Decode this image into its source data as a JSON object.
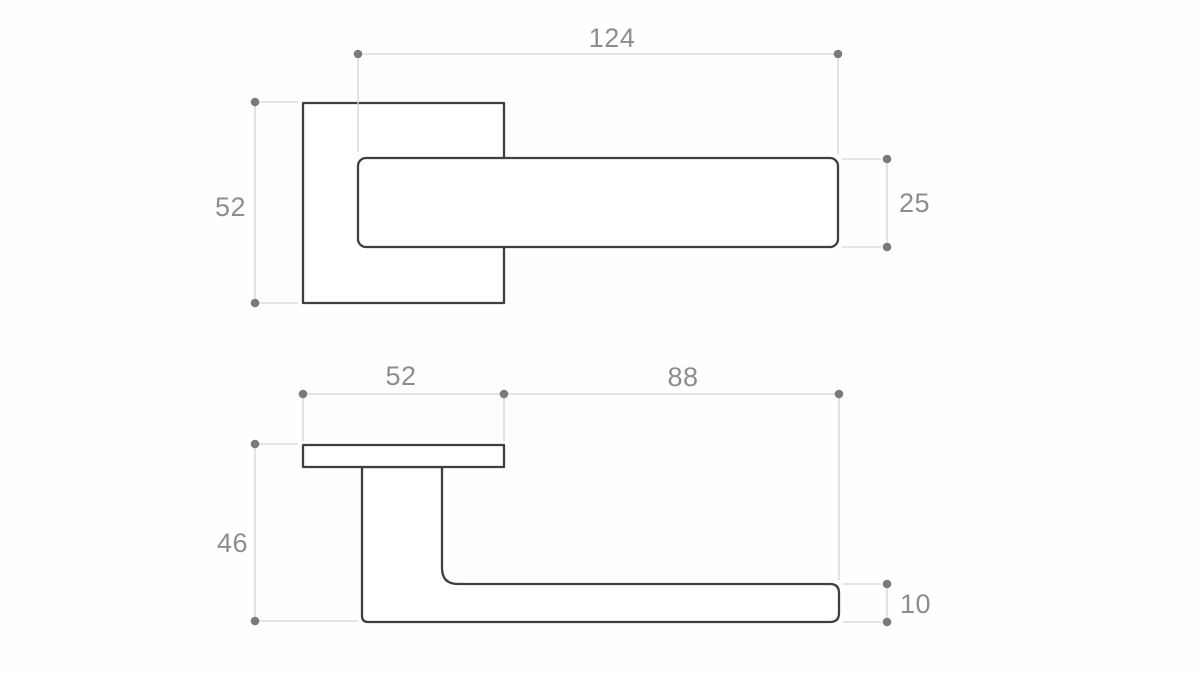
{
  "drawing": {
    "type": "technical-dimension-drawing",
    "subject": "door-lever-handle-on-square-rosette",
    "unit_note": "",
    "colors": {
      "background": "#fefefe",
      "outline": "#3f3f3f",
      "dimension_line": "#d4d4d4",
      "dimension_dot": "#7a7a7a",
      "dimension_text": "#8d8d8d"
    },
    "views": {
      "front": {
        "name": "front-view",
        "dimensions": {
          "lever_length": "124",
          "rosette_height": "52",
          "lever_thickness": "25"
        }
      },
      "side": {
        "name": "side-view",
        "dimensions": {
          "rosette_width": "52",
          "grip_length": "88",
          "handle_depth": "46",
          "grip_thickness": "10"
        }
      }
    }
  }
}
